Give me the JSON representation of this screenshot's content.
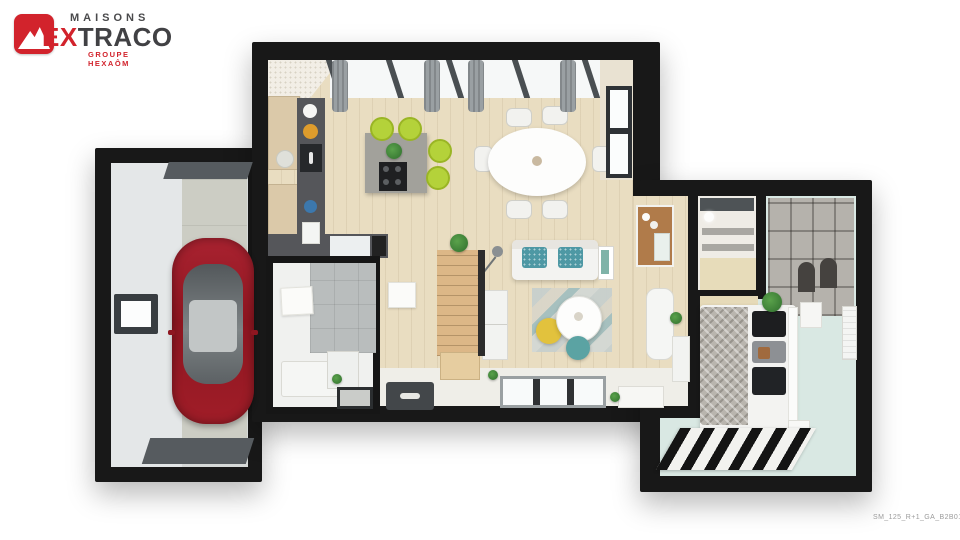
{
  "brand": {
    "line1": "MAISONS",
    "line2_accent": "EX",
    "line2_rest": "TRACO",
    "tagline": "GROUPE HEXAÔM"
  },
  "footer": {
    "plan_code": "SM_125_R+1_GA_B2B01"
  },
  "colors": {
    "brand_red": "#d2232c",
    "brand_dark": "#414144",
    "wall": "#181818",
    "wood_floor": "#e9ddc1",
    "white_floor": "#efeee8",
    "garage_floor": "#d9dcdd",
    "concrete": "#cccdc4",
    "mint_floor": "#d9e8e3",
    "car_red": "#9c1b24",
    "stool_lime": "#b4d23a",
    "sofa_teal": "#4e98a4",
    "pouf_yellow": "#e2c23d",
    "pouf_teal": "#5ba3a3",
    "stairs_wood": "#dcb787",
    "tile_gray": "#b9bdbd",
    "shelf_gray": "#b5b2ac",
    "counter_dark": "#55565a"
  }
}
